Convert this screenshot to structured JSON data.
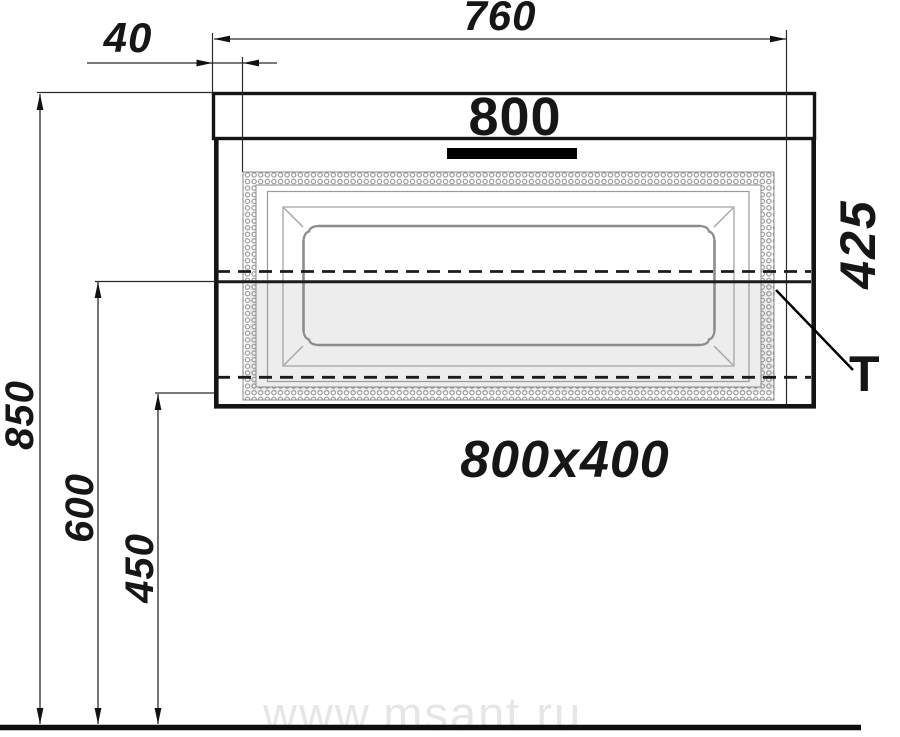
{
  "drawing": {
    "product_label": "800",
    "size_label": "800x400",
    "marker": "T",
    "dimensions": {
      "top_width": "760",
      "side_offset": "40",
      "cabinet_height": "425",
      "mounting_height": "850",
      "mid_height": "600",
      "lower_height": "450"
    },
    "watermark": "www.msant.ru",
    "colors": {
      "line": "#111111",
      "frame_gray": "#8c8c8c",
      "shade_gray": "#ededed",
      "watermark_gray": "#e6e6e6"
    }
  }
}
